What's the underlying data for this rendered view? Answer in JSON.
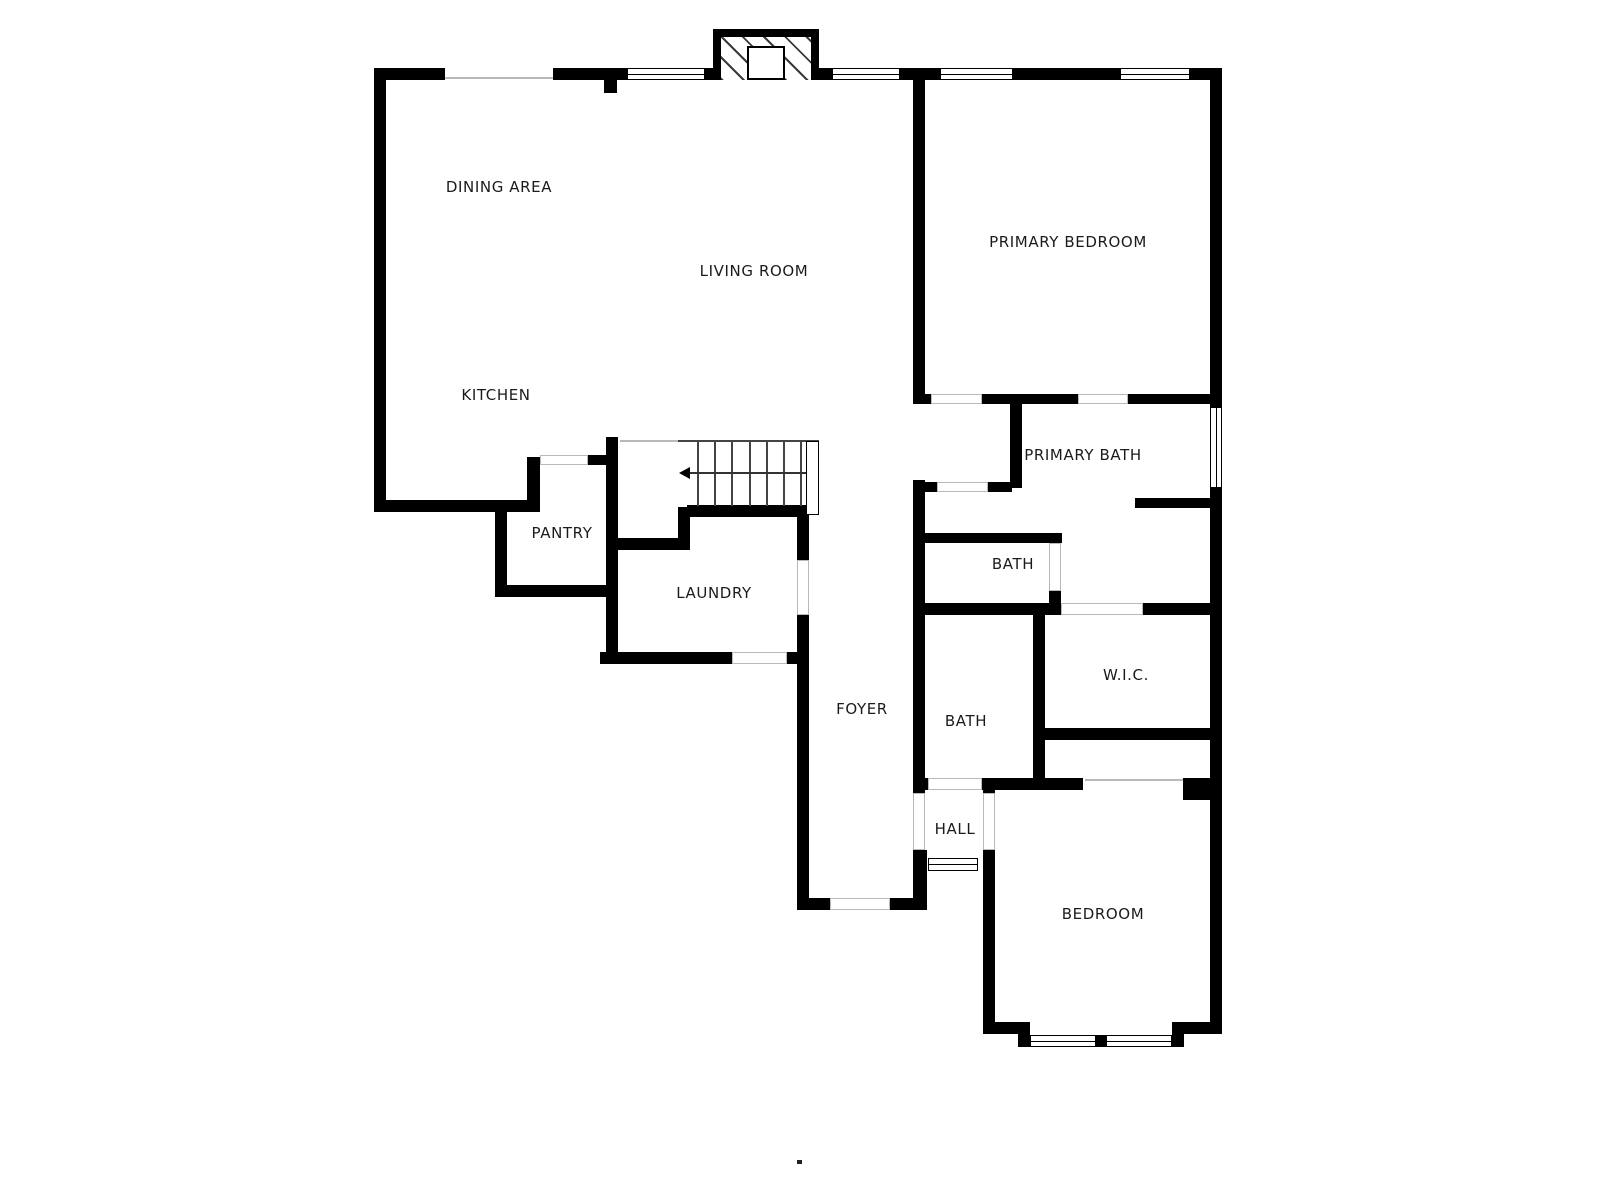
{
  "plan_title": "Floor plan",
  "colors": {
    "wall": "#000000",
    "background": "#ffffff",
    "opening_line": "#b9b9b9",
    "text": "#1b1b1b"
  },
  "rooms": [
    {
      "id": "dining-area",
      "label": "DINING AREA",
      "x": 499,
      "y": 187
    },
    {
      "id": "living-room",
      "label": "LIVING ROOM",
      "x": 754,
      "y": 271
    },
    {
      "id": "kitchen",
      "label": "KITCHEN",
      "x": 496,
      "y": 395
    },
    {
      "id": "primary-bedroom",
      "label": "PRIMARY BEDROOM",
      "x": 1068,
      "y": 242
    },
    {
      "id": "primary-bath",
      "label": "PRIMARY BATH",
      "x": 1083,
      "y": 455
    },
    {
      "id": "pantry",
      "label": "PANTRY",
      "x": 562,
      "y": 533
    },
    {
      "id": "laundry",
      "label": "LAUNDRY",
      "x": 714,
      "y": 593
    },
    {
      "id": "bath-primary-wc",
      "label": "BATH",
      "x": 1013,
      "y": 564
    },
    {
      "id": "wic",
      "label": "W.I.C.",
      "x": 1126,
      "y": 675
    },
    {
      "id": "bath-hall",
      "label": "BATH",
      "x": 966,
      "y": 721
    },
    {
      "id": "foyer",
      "label": "FOYER",
      "x": 862,
      "y": 709
    },
    {
      "id": "hall",
      "label": "HALL",
      "x": 955,
      "y": 829
    },
    {
      "id": "bedroom",
      "label": "BEDROOM",
      "x": 1103,
      "y": 914
    }
  ],
  "walls": [
    [
      374,
      68,
      71,
      12
    ],
    [
      553,
      68,
      74,
      12
    ],
    [
      705,
      68,
      8,
      12
    ],
    [
      819,
      68,
      13,
      12
    ],
    [
      900,
      68,
      40,
      12
    ],
    [
      1013,
      68,
      107,
      12
    ],
    [
      1190,
      68,
      32,
      12
    ],
    [
      374,
      68,
      12,
      444
    ],
    [
      604,
      80,
      13,
      13
    ],
    [
      1210,
      68,
      12,
      339
    ],
    [
      1210,
      488,
      12,
      545
    ],
    [
      374,
      500,
      166,
      12
    ],
    [
      527,
      457,
      13,
      47
    ],
    [
      495,
      507,
      12,
      90
    ],
    [
      495,
      585,
      123,
      12
    ],
    [
      588,
      455,
      20,
      10
    ],
    [
      606,
      437,
      12,
      227
    ],
    [
      606,
      538,
      81,
      12
    ],
    [
      687,
      505,
      120,
      12
    ],
    [
      678,
      507,
      12,
      43
    ],
    [
      600,
      652,
      132,
      12
    ],
    [
      787,
      652,
      21,
      12
    ],
    [
      797,
      507,
      12,
      53
    ],
    [
      797,
      615,
      12,
      283
    ],
    [
      797,
      898,
      33,
      12
    ],
    [
      890,
      898,
      37,
      12
    ],
    [
      913,
      80,
      12,
      314
    ],
    [
      913,
      394,
      18,
      10
    ],
    [
      982,
      394,
      96,
      10
    ],
    [
      1128,
      394,
      94,
      10
    ],
    [
      1010,
      404,
      12,
      84
    ],
    [
      988,
      482,
      24,
      10
    ],
    [
      913,
      482,
      24,
      10
    ],
    [
      913,
      480,
      12,
      133
    ],
    [
      913,
      533,
      149,
      10
    ],
    [
      913,
      603,
      148,
      12
    ],
    [
      1049,
      591,
      12,
      12
    ],
    [
      1135,
      498,
      87,
      10
    ],
    [
      1033,
      613,
      12,
      169
    ],
    [
      1143,
      603,
      79,
      12
    ],
    [
      1033,
      728,
      189,
      12
    ],
    [
      913,
      613,
      12,
      180
    ],
    [
      913,
      778,
      15,
      12
    ],
    [
      982,
      778,
      101,
      12
    ],
    [
      1183,
      778,
      29,
      22
    ],
    [
      913,
      850,
      14,
      60
    ],
    [
      983,
      778,
      12,
      15
    ],
    [
      983,
      850,
      12,
      172
    ],
    [
      983,
      1022,
      47,
      12
    ],
    [
      1018,
      1030,
      12,
      17
    ],
    [
      1096,
      1035,
      10,
      12
    ],
    [
      1172,
      1030,
      12,
      17
    ],
    [
      1172,
      1022,
      50,
      12
    ]
  ],
  "windows": [
    {
      "rect": [
        627,
        68,
        78,
        12
      ],
      "dir": "h"
    },
    {
      "rect": [
        832,
        68,
        68,
        12
      ],
      "dir": "h"
    },
    {
      "rect": [
        940,
        68,
        73,
        12
      ],
      "dir": "h"
    },
    {
      "rect": [
        1120,
        68,
        70,
        12
      ],
      "dir": "h"
    },
    {
      "rect": [
        1210,
        407,
        12,
        81
      ],
      "dir": "v"
    },
    {
      "rect": [
        1030,
        1035,
        66,
        12
      ],
      "dir": "h"
    },
    {
      "rect": [
        1106,
        1035,
        66,
        12
      ],
      "dir": "h"
    },
    {
      "rect": [
        928,
        858,
        50,
        13
      ],
      "dir": "h"
    }
  ],
  "openings": [
    [
      931,
      394,
      51,
      10
    ],
    [
      1078,
      394,
      50,
      10
    ],
    [
      937,
      482,
      51,
      10
    ],
    [
      1049,
      543,
      12,
      48
    ],
    [
      1061,
      603,
      82,
      12
    ],
    [
      928,
      778,
      54,
      12
    ],
    [
      913,
      793,
      12,
      57
    ],
    [
      983,
      793,
      12,
      57
    ],
    [
      797,
      560,
      12,
      55
    ],
    [
      732,
      652,
      55,
      12
    ],
    [
      830,
      898,
      60,
      12
    ],
    [
      540,
      455,
      48,
      10
    ]
  ],
  "thin_lines": [
    [
      445,
      77,
      108,
      2
    ],
    [
      620,
      440,
      58,
      2
    ],
    [
      1085,
      779,
      98,
      2
    ]
  ],
  "stairs": {
    "box": [
      678,
      440,
      141,
      66
    ],
    "treads_x": [
      697,
      714,
      731,
      749,
      766,
      783,
      800
    ],
    "tread_height": 65,
    "rail": [
      806,
      441,
      13,
      74
    ],
    "midline": {
      "x": 690,
      "y": 472,
      "w": 116
    },
    "arrow": {
      "x": 679,
      "y": 467
    }
  },
  "fireplace": {
    "outer": [
      713,
      29,
      106,
      51
    ],
    "hatch": [
      721,
      37,
      90,
      43
    ],
    "firebox": [
      747,
      46,
      38,
      34
    ]
  },
  "dot": [
    797,
    1160,
    5,
    4
  ]
}
